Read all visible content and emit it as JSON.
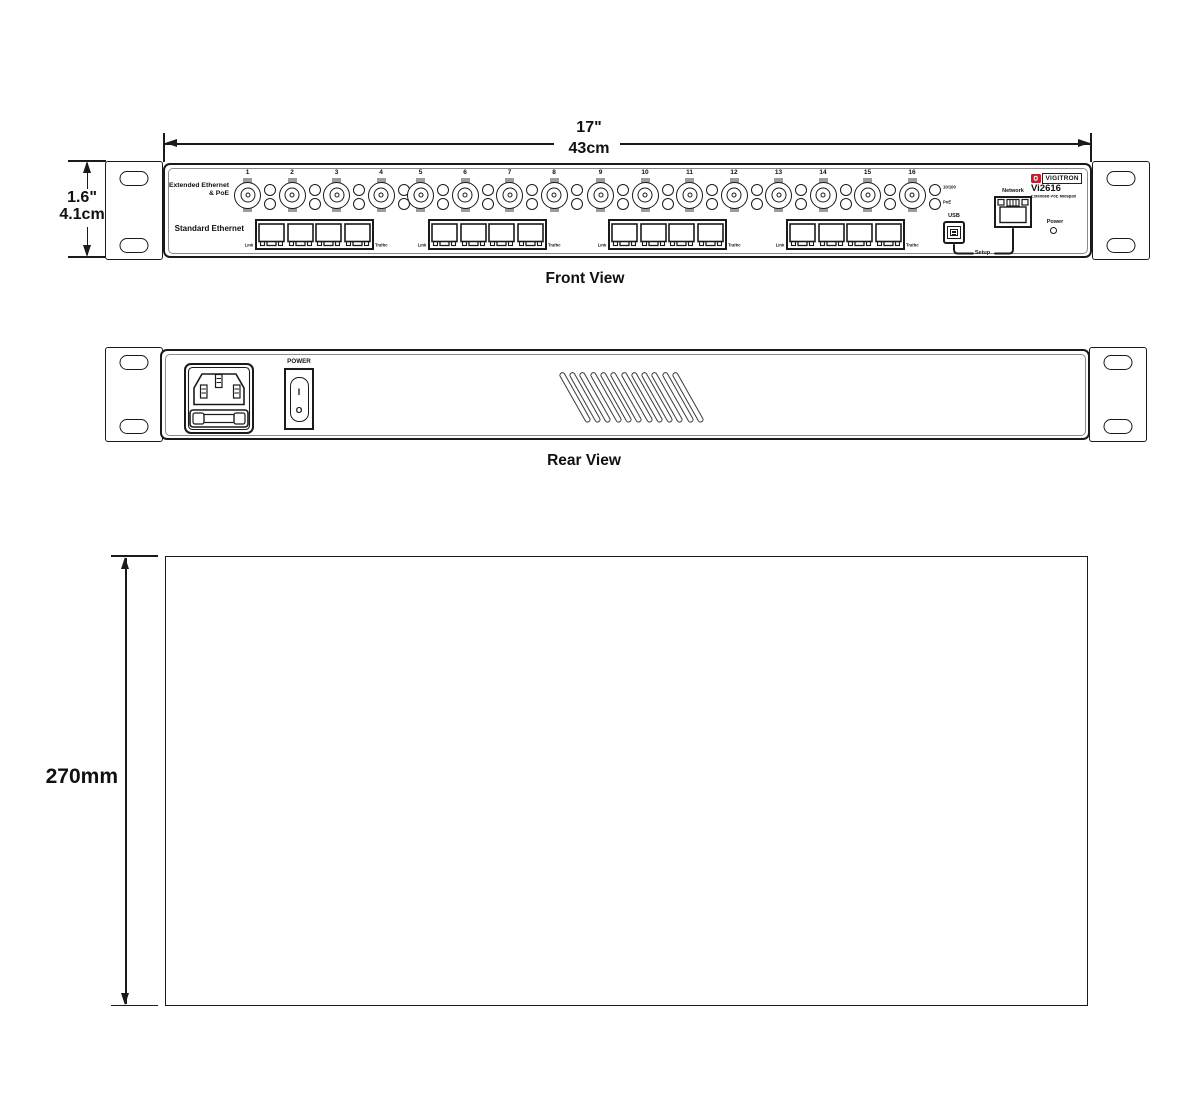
{
  "front": {
    "caption": "Front View",
    "width_dimension": {
      "inches": "17\"",
      "cm": "43cm"
    },
    "height_dimension": {
      "inches": "1.6\"",
      "cm": "4.1cm"
    },
    "extended_label_line1": "Extended Ethernet",
    "extended_label_line2": "& PoE",
    "standard_label": "Standard Ethernet",
    "bnc_port_numbers": [
      "1",
      "2",
      "3",
      "4",
      "5",
      "6",
      "7",
      "8",
      "9",
      "10",
      "11",
      "12",
      "13",
      "14",
      "15",
      "16"
    ],
    "port_led_labels": {
      "top": "10/100",
      "bottom": "PoE"
    },
    "ethernet_groups": [
      {
        "left_label": "Link",
        "right_label": "Traffic"
      },
      {
        "left_label": "Link",
        "right_label": "Traffic"
      },
      {
        "left_label": "Link",
        "right_label": "Traffic"
      },
      {
        "left_label": "Link",
        "right_label": "Traffic"
      }
    ],
    "usb_label": "USB",
    "network_label": "Network",
    "setup_label": "Setup",
    "power_label": "Power",
    "logo": {
      "brand": "VIGITRON",
      "model": "Vi2616",
      "subtitle": "Extended PoE Midspan",
      "accent_color": "#c41e2a"
    }
  },
  "rear": {
    "caption": "Rear View",
    "power_switch_label": "POWER",
    "switch_on_symbol": "I",
    "switch_off_symbol": "O",
    "vent_slot_count": 12
  },
  "bottom_view": {
    "depth_dimension": "270mm"
  }
}
